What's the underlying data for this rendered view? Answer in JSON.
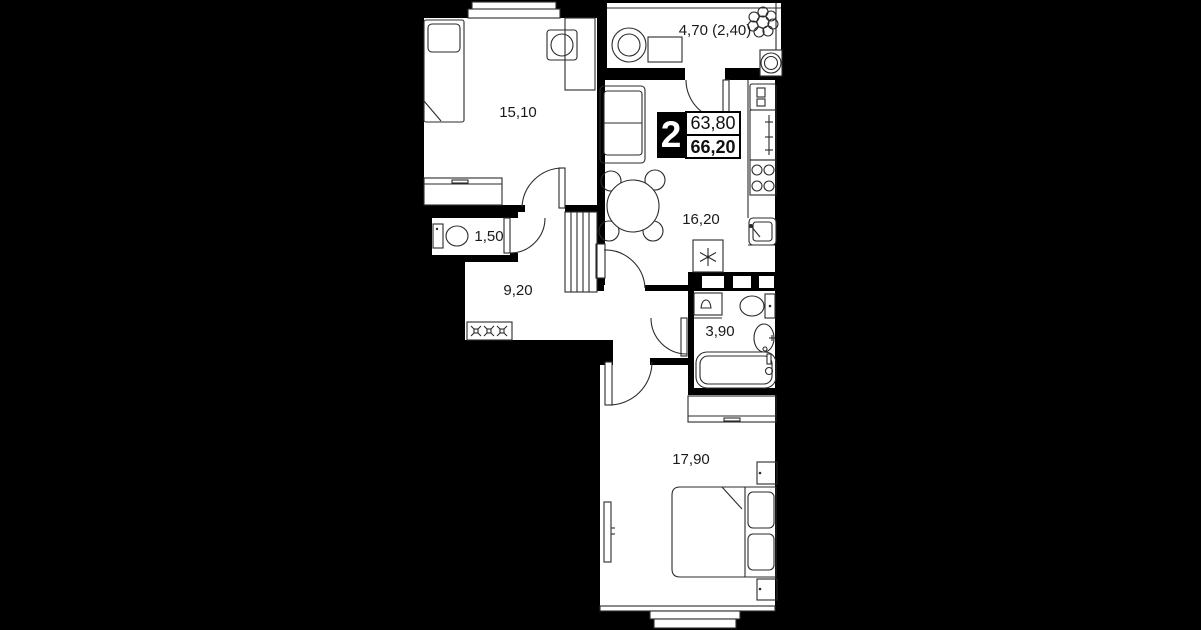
{
  "plan": {
    "type": "apartment-floor-plan",
    "colors": {
      "background": "#000000",
      "floor": "#ffffff",
      "wall": "#000000",
      "line": "#2b2b2b",
      "label": "#1a1a1a"
    },
    "badge": {
      "rooms_count": "2",
      "area_top": "63,80",
      "area_bottom": "66,20"
    },
    "rooms": [
      {
        "id": "bedroom-top",
        "area": "15,10"
      },
      {
        "id": "balcony",
        "area": "4,70 (2,40)"
      },
      {
        "id": "living-kitchen",
        "area": "16,20"
      },
      {
        "id": "wc",
        "area": "1,50"
      },
      {
        "id": "hallway",
        "area": "9,20"
      },
      {
        "id": "bathroom",
        "area": "3,90"
      },
      {
        "id": "bedroom-bottom",
        "area": "17,90"
      }
    ]
  }
}
